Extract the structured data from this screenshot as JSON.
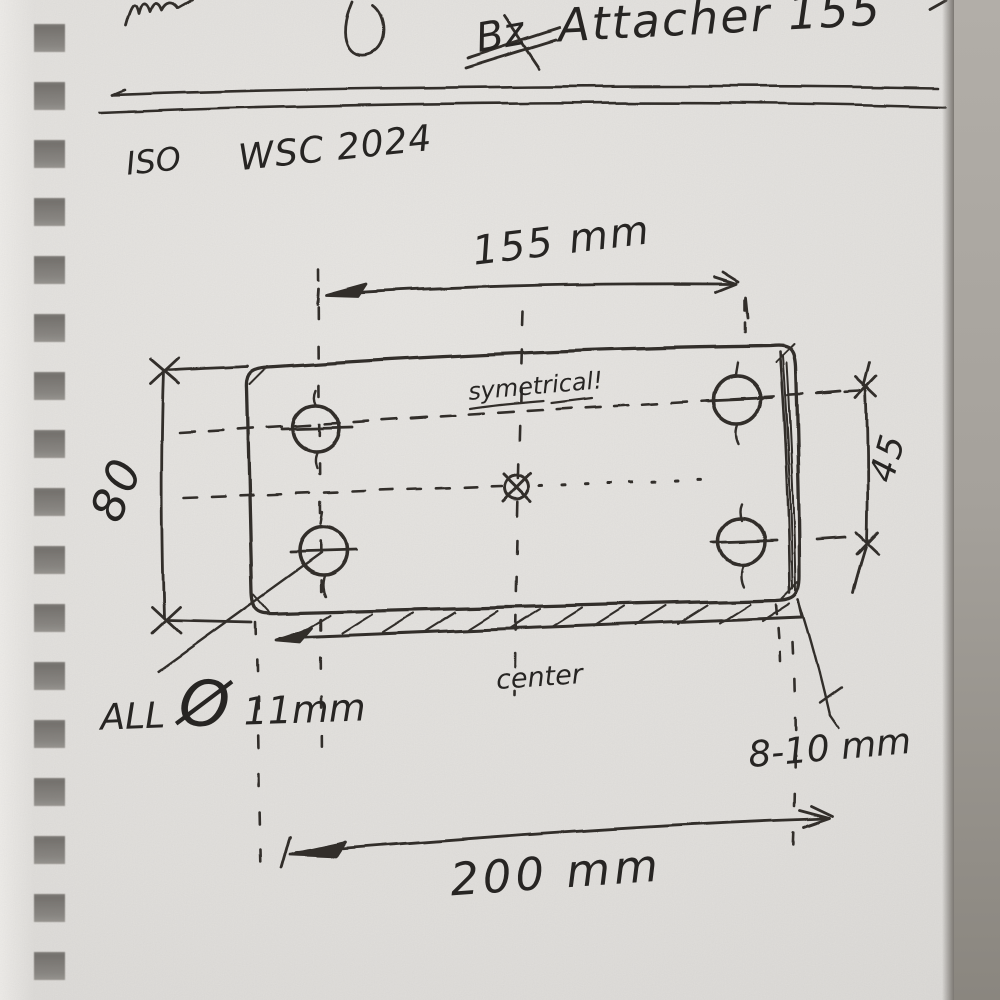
{
  "header": {
    "title": "Attacher 155",
    "crossed_out": "Bz",
    "standard": "ISO",
    "code": "WSC 2024"
  },
  "dimensions": {
    "top_width": "155 mm",
    "bottom_width": "200 mm",
    "left_height": "80",
    "right_spacing": "45",
    "thickness": "8-10 mm"
  },
  "annotations": {
    "symmetry": "symetrical!",
    "center": "center",
    "holes_prefix": "ALL",
    "diameter_symbol": "Ø",
    "holes_diameter": "11mm"
  },
  "colors": {
    "ink": "#312e2b",
    "paper": "#e5e3e0",
    "table": "#a19d97"
  }
}
